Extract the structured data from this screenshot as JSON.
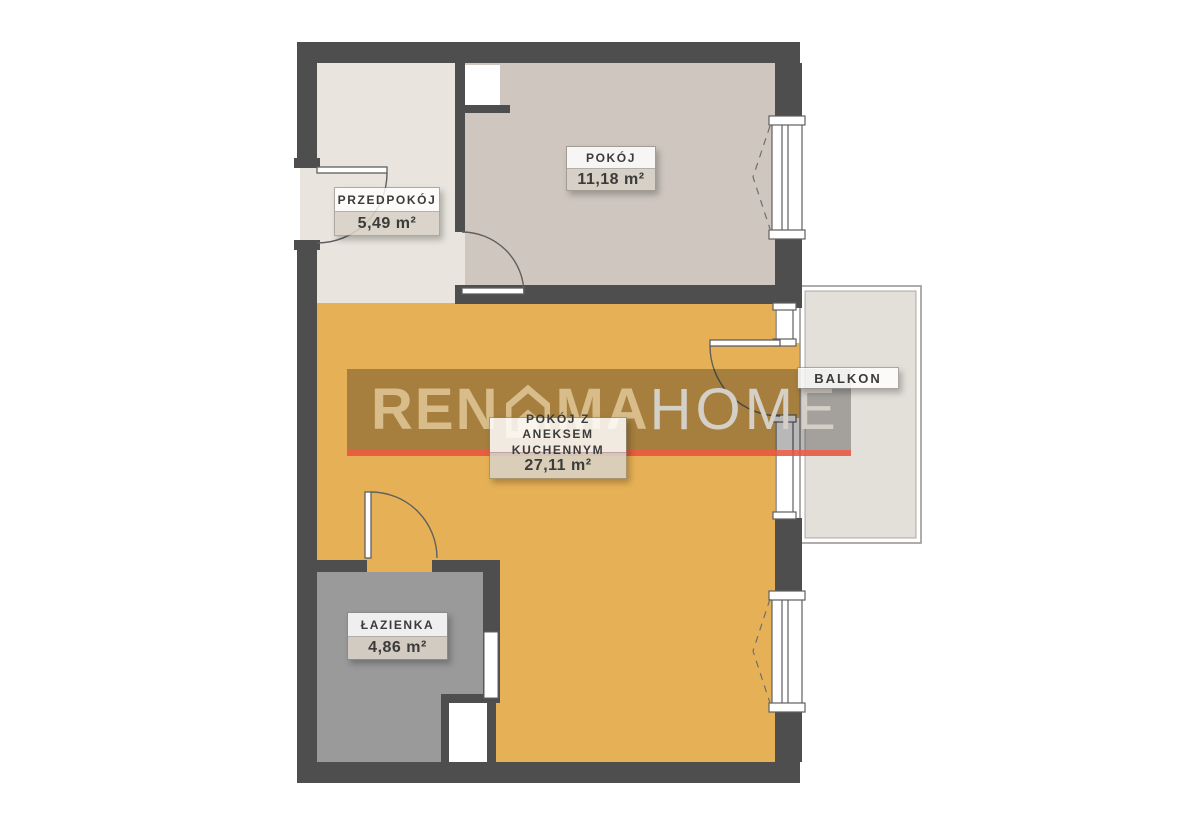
{
  "watermark": {
    "brand_part1": "REN",
    "brand_part2": "MA",
    "brand_part3": "HOME",
    "house_icon": "house-icon"
  },
  "rooms": {
    "przedpokoj": {
      "name": "PRZEDPOKÓJ",
      "area": "5,49 m²"
    },
    "pokoj": {
      "name": "POKÓJ",
      "area": "11,18 m²"
    },
    "main": {
      "name_line1": "POKÓJ Z ANEKSEM",
      "name_line2": "KUCHENNYM",
      "area": "27,11 m²"
    },
    "lazienka": {
      "name": "ŁAZIENKA",
      "area": "4,86 m²"
    },
    "balkon": {
      "name": "BALKON"
    }
  },
  "colors": {
    "wall": "#4e4e4e",
    "hall_floor": "#e9e5de",
    "pokoj_floor": "#cfc7bf",
    "main_floor": "#e6b156",
    "bath_floor": "#9b9a9b",
    "balcony_floor": "#e3e0d9",
    "text_dark": "#3b3b3b",
    "line": "#5f5f5f",
    "watermark_band": "rgba(0,0,0,0.28)",
    "watermark_red": "rgba(230,80,60,0.85)",
    "brand_sand": "#d8bd8b",
    "brand_light_color": "#d5d0c7"
  }
}
